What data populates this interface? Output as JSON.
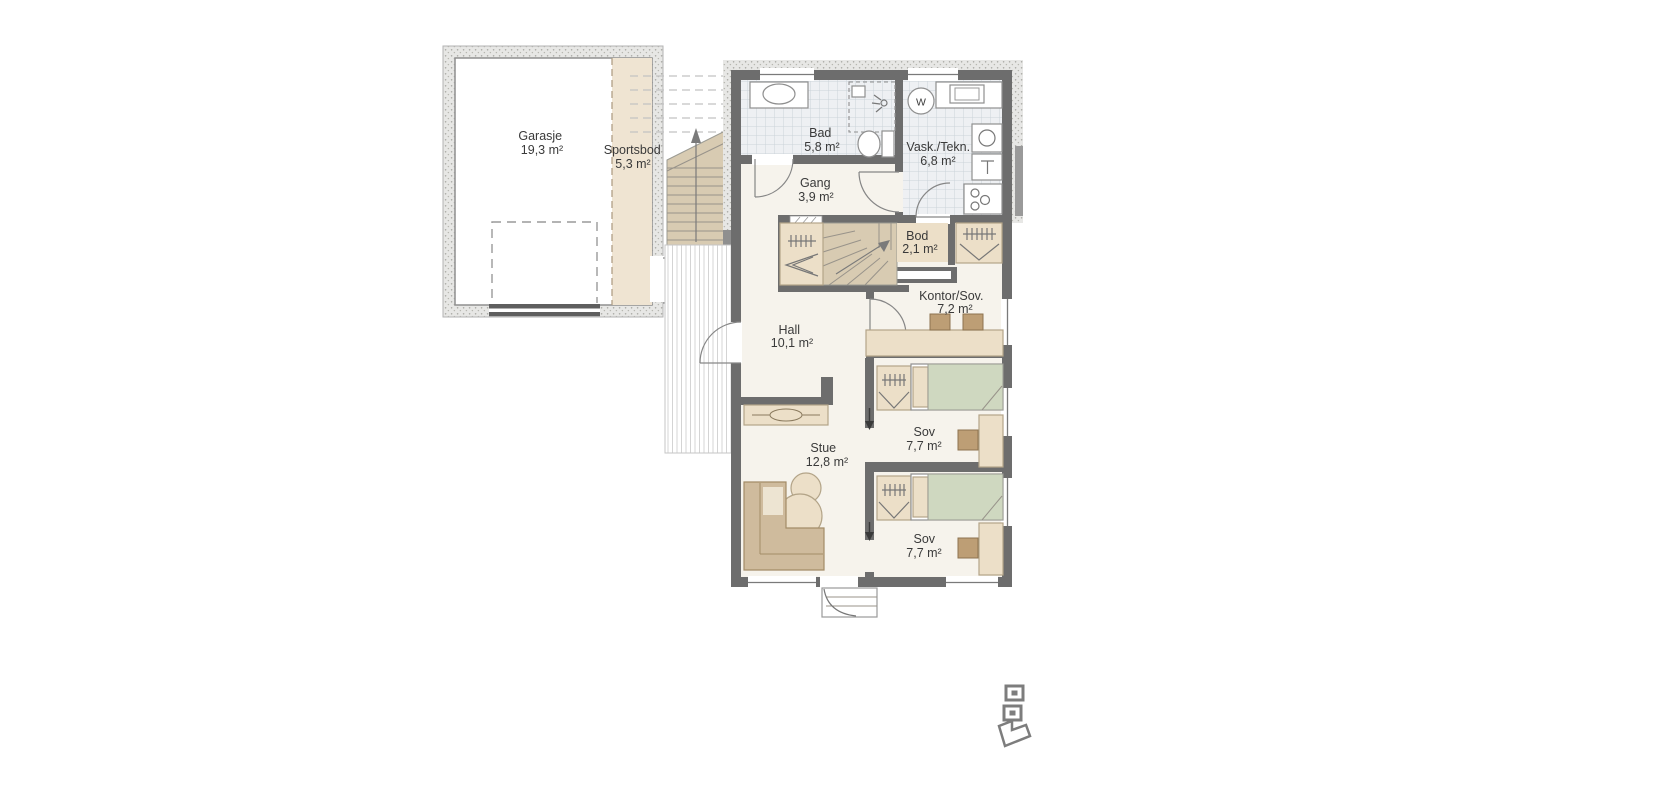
{
  "colors": {
    "wall": "#6d6d6d",
    "wallLight": "#9a9a9a",
    "furniture": "#ecdfc8",
    "furnBorder": "#b3a488",
    "woodDark": "#d8cbb2",
    "bed": "#cfd8c0",
    "chair": "#bd9e75",
    "sofa": "#cfbb9d",
    "sofaBorder": "#a38c67",
    "floor": "#f6f3ec",
    "tileBg": "#eef0f3",
    "tileLine": "#ccd3da",
    "sportsbodFloor": "#efe4d2",
    "ink": "#3a3a3a"
  },
  "rooms": [
    {
      "name": "Garasje",
      "area": "19,3 m²"
    },
    {
      "name": "Sportsbod",
      "area": "5,3 m²"
    },
    {
      "name": "Bad",
      "area": "5,8 m²"
    },
    {
      "name": "Vask./Tekn.",
      "area": "6,8 m²"
    },
    {
      "name": "Gang",
      "area": "3,9 m²"
    },
    {
      "name": "Bod",
      "area": "2,1 m²"
    },
    {
      "name": "Kontor/Sov.",
      "area": "7,2 m²"
    },
    {
      "name": "Hall",
      "area": "10,1 m²"
    },
    {
      "name": "Sov",
      "area": "7,7 m²"
    },
    {
      "name": "Stue",
      "area": "12,8 m²"
    },
    {
      "name": "Sov",
      "area": "7,7 m²"
    }
  ],
  "symbols": {
    "washer": "W"
  }
}
